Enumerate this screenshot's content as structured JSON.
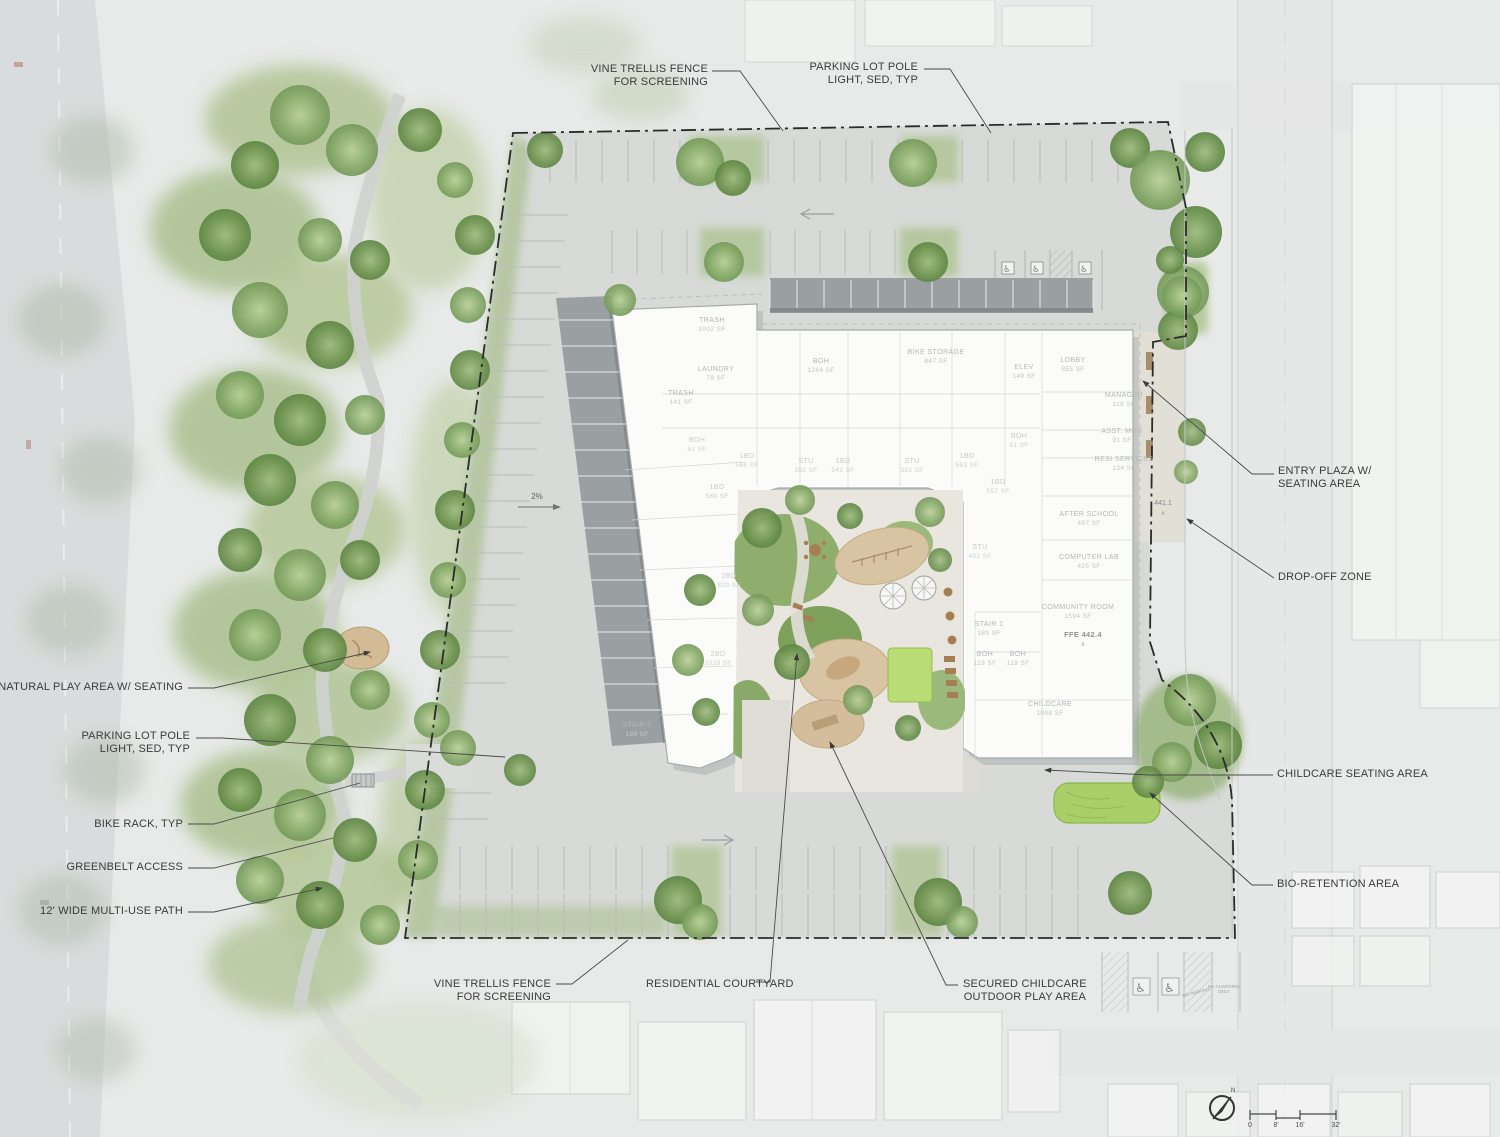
{
  "callouts": {
    "vine_trellis_top": {
      "line1": "VINE TRELLIS FENCE",
      "line2": "FOR SCREENING"
    },
    "parking_pole_top": {
      "line1": "PARKING LOT POLE",
      "line2": "LIGHT, SED, TYP"
    },
    "entry_plaza": {
      "line1": "ENTRY PLAZA W/",
      "line2": "SEATING AREA"
    },
    "drop_off_zone": {
      "line1": "DROP-OFF ZONE"
    },
    "childcare_seating": {
      "line1": "CHILDCARE SEATING AREA"
    },
    "bio_retention": {
      "line1": "BIO-RETENTION AREA"
    },
    "natural_play": {
      "line1": "NATURAL PLAY AREA W/ SEATING"
    },
    "parking_pole_left": {
      "line1": "PARKING LOT POLE",
      "line2": "LIGHT, SED, TYP"
    },
    "bike_rack": {
      "line1": "BIKE RACK, TYP"
    },
    "greenbelt_access": {
      "line1": "GREENBELT ACCESS"
    },
    "multi_use_path": {
      "line1": "12' WIDE MULTI-USE PATH"
    },
    "vine_trellis_bottom": {
      "line1": "VINE TRELLIS FENCE",
      "line2": "FOR SCREENING"
    },
    "residential_courtyard": {
      "line1": "RESIDENTIAL COURTYARD"
    },
    "secured_childcare": {
      "line1": "SECURED CHILDCARE",
      "line2": "OUTDOOR PLAY AREA"
    }
  },
  "rooms": {
    "trash_main": {
      "name": "TRASH",
      "area": "1002 SF"
    },
    "laundry": {
      "name": "LAUNDRY",
      "area": "78 SF"
    },
    "trash_small": {
      "name": "TRASH",
      "area": "141 SF"
    },
    "boh_main": {
      "name": "BOH",
      "area": "1264 SF"
    },
    "bike_storage": {
      "name": "BIKE STORAGE",
      "area": "847 SF"
    },
    "elev": {
      "name": "ELEV",
      "area": "149 SF"
    },
    "lobby": {
      "name": "LOBBY",
      "area": "855 SF"
    },
    "manager": {
      "name": "MANAGER",
      "area": "119 SF"
    },
    "asst_mgr": {
      "name": "ASST. MGR",
      "area": "91 SF"
    },
    "resi_services": {
      "name": "RESI SERVICES",
      "area": "134 SF"
    },
    "after_school": {
      "name": "AFTER SCHOOL",
      "area": "497 SF"
    },
    "computer_lab": {
      "name": "COMPUTER LAB",
      "area": "425 SF"
    },
    "community_room": {
      "name": "COMMUNITY ROOM",
      "area": "1594 SF"
    },
    "stair_1": {
      "name": "STAIR 1",
      "area": "189 SF"
    },
    "boh_a": {
      "name": "BOH",
      "area": "119 SF"
    },
    "boh_b": {
      "name": "BOH",
      "area": "119 SF"
    },
    "childcare": {
      "name": "CHILDCARE",
      "area": "1098 SF"
    },
    "stair_2": {
      "name": "STAIR 2",
      "area": "189 SF"
    },
    "boh_west": {
      "name": "BOH",
      "area": "61 SF"
    },
    "boh_east": {
      "name": "BOH",
      "area": "81 SF"
    },
    "unit_1bd_a": {
      "name": "1BD",
      "area": "568 SF"
    },
    "unit_1bd_b": {
      "name": "1BD",
      "area": "569 SF"
    },
    "unit_stu_a": {
      "name": "STU",
      "area": "392 SF"
    },
    "unit_1bd_c": {
      "name": "1BD",
      "area": "542 SF"
    },
    "unit_stu_b": {
      "name": "STU",
      "area": "392 SF"
    },
    "unit_stu_c": {
      "name": "STU",
      "area": "402 SF"
    },
    "unit_1bd_d": {
      "name": "1BD",
      "area": "563 SF"
    },
    "unit_1bd_e": {
      "name": "1BD",
      "area": "557 SF"
    },
    "unit_2bd_a": {
      "name": "2BD",
      "area": "829 SF"
    },
    "unit_2bd_b": {
      "name": "2BD",
      "area": "1029 SF"
    }
  },
  "annotations": {
    "slope": "2%",
    "spot_elevation": "441.1",
    "spot_mark": "x",
    "ffe": "FFE 442.4",
    "no_parking": "NO PARKING",
    "ev_charging_line1": "EV CHARGING",
    "ev_charging_line2": "ONLY"
  },
  "scale_bar": {
    "tick_0": "0",
    "tick_8": "8'",
    "tick_16": "16'",
    "tick_32": "32'"
  },
  "compass": {
    "north": "N"
  },
  "icons": {
    "wheelchair": "♿"
  },
  "colors": {
    "boundary": "#2b2b2b",
    "tree_canopy": "#6f9450",
    "lawn": "#b9dd74",
    "play_sand": "#d8c3a2",
    "asphalt": "#d8dad6",
    "building": "#fbfbfa",
    "bio_retention": "#a9d068",
    "label_text": "#3b3b3b"
  }
}
